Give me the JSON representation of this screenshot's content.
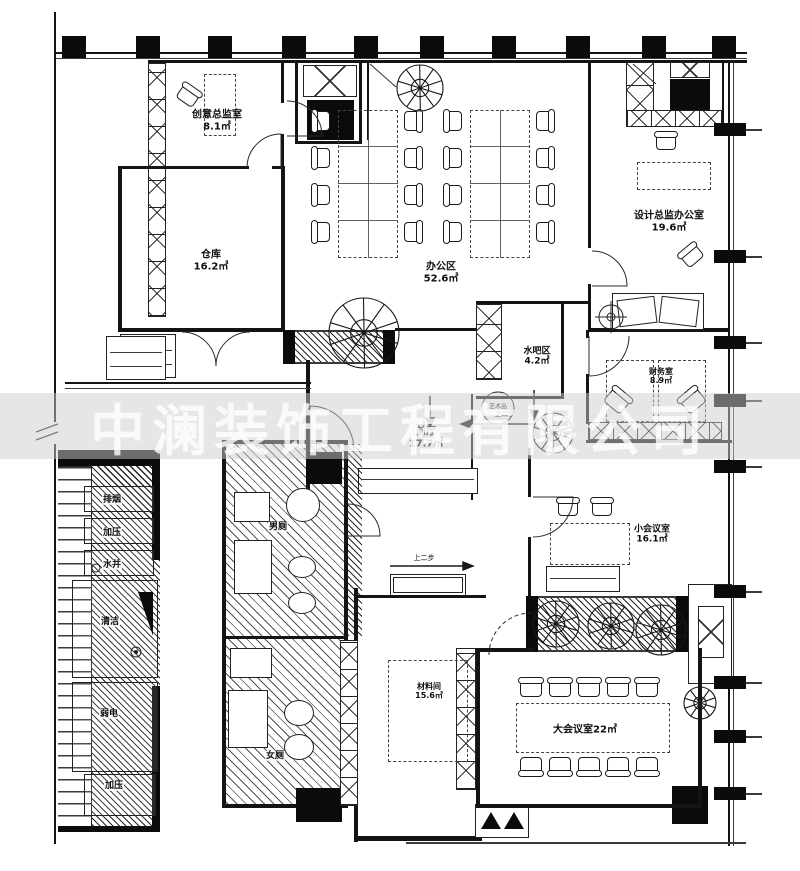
{
  "watermark": "中澜装饰工程有限公司",
  "rooms": {
    "creative_director": {
      "name": "创意总监室",
      "area": "8.1㎡"
    },
    "warehouse": {
      "name": "仓库",
      "area": "16.2㎡"
    },
    "office_area": {
      "name": "办公区",
      "area": "52.6㎡"
    },
    "design_director": {
      "name": "设计总监办公室",
      "area": "19.6㎡"
    },
    "water_bar": {
      "name": "水吧区",
      "area": "4.2㎡"
    },
    "finance": {
      "name": "财务室",
      "area": "8.9㎡"
    },
    "front_hall": {
      "name": "前厅",
      "area": "17.7㎡"
    },
    "small_meeting": {
      "name": "小会议室",
      "area": "16.1㎡"
    },
    "large_meeting": {
      "name": "大会议室",
      "area": "22㎡"
    },
    "material_room": {
      "name": "材料间",
      "area": "15.6㎡"
    },
    "mens_wc": {
      "name": "男厕"
    },
    "womens_wc": {
      "name": "女厕"
    }
  },
  "shafts": {
    "smoke_exhaust": "排烟",
    "pressurization_top": "加压",
    "water_well": "水井",
    "cleaning": "清洁",
    "low_voltage": "弱电",
    "pressurization_bottom": "加压"
  },
  "annotations": {
    "artwork": "艺术品",
    "up_two_steps": "上二步"
  }
}
